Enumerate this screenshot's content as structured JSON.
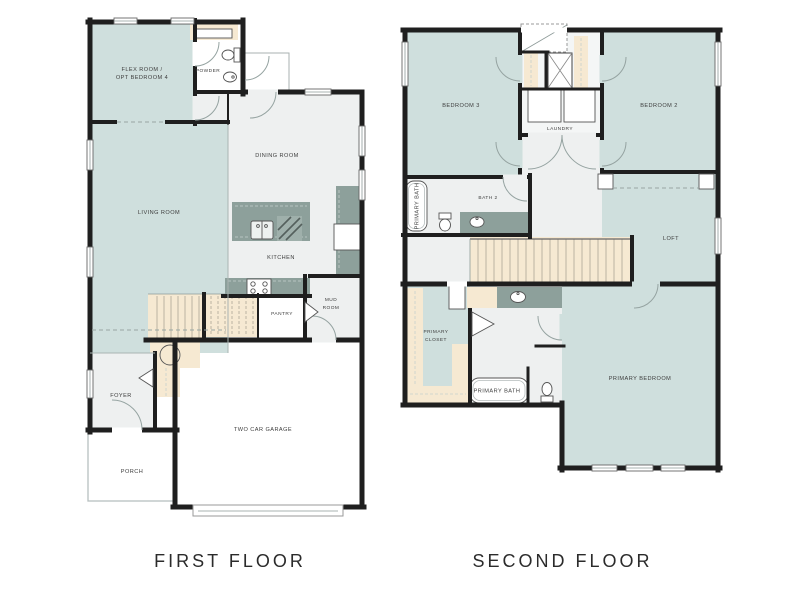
{
  "titles": {
    "first_floor": "FIRST FLOOR",
    "second_floor": "SECOND FLOOR"
  },
  "colors": {
    "room_teal": "#cfdfdd",
    "room_gray": "#eef0f0",
    "stairs_tan": "#f6e9d2",
    "counter_green": "#8da09b",
    "wall": "#1f1f1f",
    "label_text": "#3d3d3d"
  },
  "first_floor": {
    "flex_room": {
      "line1": "FLEX ROOM /",
      "line2": "OPT BEDROOM 4"
    },
    "powder": "POWDER",
    "dining_room": "DINING ROOM",
    "living_room": "LIVING ROOM",
    "kitchen": "KITCHEN",
    "pantry": "PANTRY",
    "mud_room": {
      "line1": "MUD",
      "line2": "ROOM"
    },
    "foyer": "FOYER",
    "porch": "PORCH",
    "garage": "TWO CAR GARAGE"
  },
  "second_floor": {
    "bedroom_3": "BEDROOM 3",
    "bedroom_2": "BEDROOM 2",
    "laundry": "LAUNDRY",
    "bath_2": "BATH 2",
    "loft": "LOFT",
    "primary_closet": {
      "line1": "PRIMARY",
      "line2": "CLOSET"
    },
    "primary_bath_tub_label": "PRIMARY BATH",
    "primary_bath": "PRIMARY BATH",
    "primary_bedroom": "PRIMARY BEDROOM"
  }
}
